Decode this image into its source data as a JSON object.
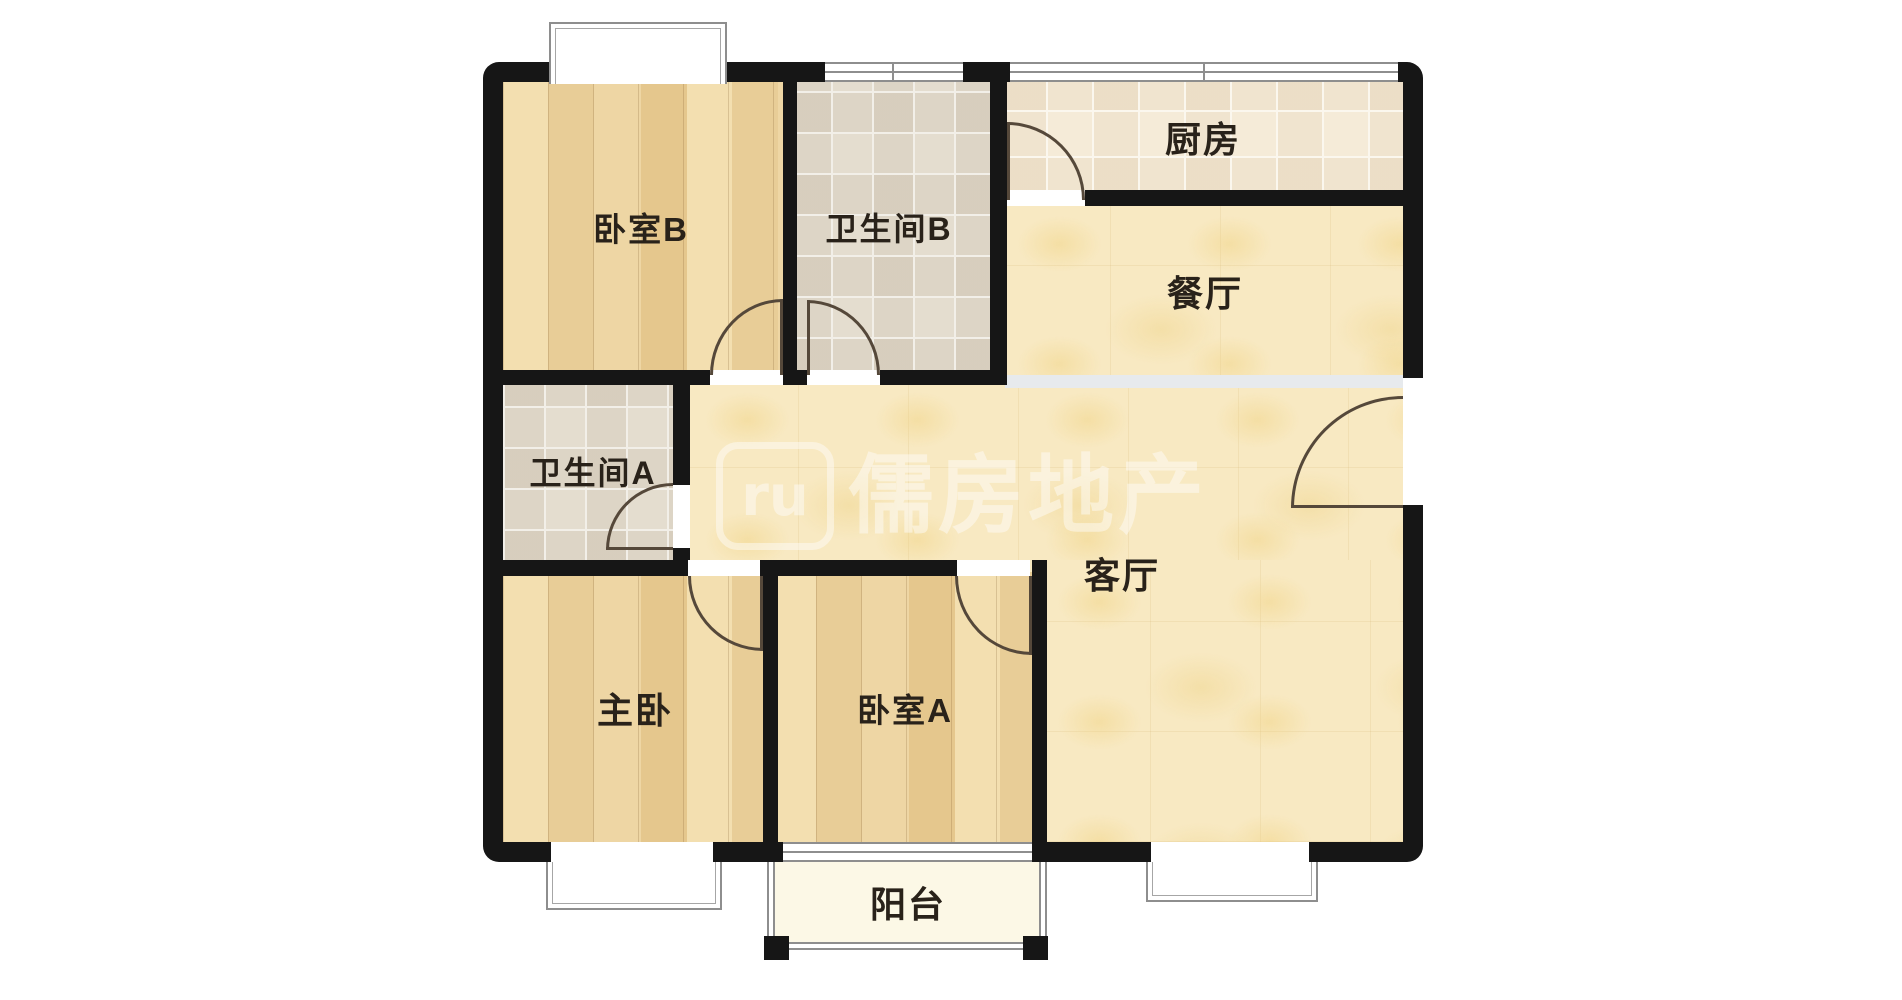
{
  "floorplan": {
    "rooms": [
      {
        "id": "bedroom-b",
        "label": "卧室B",
        "floor": "wood"
      },
      {
        "id": "bathroom-b",
        "label": "卫生间B",
        "floor": "tile"
      },
      {
        "id": "kitchen",
        "label": "厨房",
        "floor": "tile"
      },
      {
        "id": "dining-room",
        "label": "餐厅",
        "floor": "stone"
      },
      {
        "id": "bathroom-a",
        "label": "卫生间A",
        "floor": "tile"
      },
      {
        "id": "living-room",
        "label": "客厅",
        "floor": "stone"
      },
      {
        "id": "master-bedroom",
        "label": "主卧",
        "floor": "wood"
      },
      {
        "id": "bedroom-a",
        "label": "卧室A",
        "floor": "wood"
      },
      {
        "id": "balcony",
        "label": "阳台",
        "floor": "plain"
      }
    ],
    "watermark": {
      "logo_text": "ru",
      "brand_text": "儒房地产"
    },
    "colors": {
      "wall": "#161616",
      "wood_floor": "#ecd09c",
      "bath_tile": "#e4ddcf",
      "kitchen_tile": "#f5ebd8",
      "living_floor": "#f8e9c2",
      "balcony_floor": "#fcf8e6",
      "door_arc": "#55483a",
      "window_line": "#8e8e8e",
      "area_divider": "#e7eaed",
      "label_text": "#29221a"
    }
  }
}
